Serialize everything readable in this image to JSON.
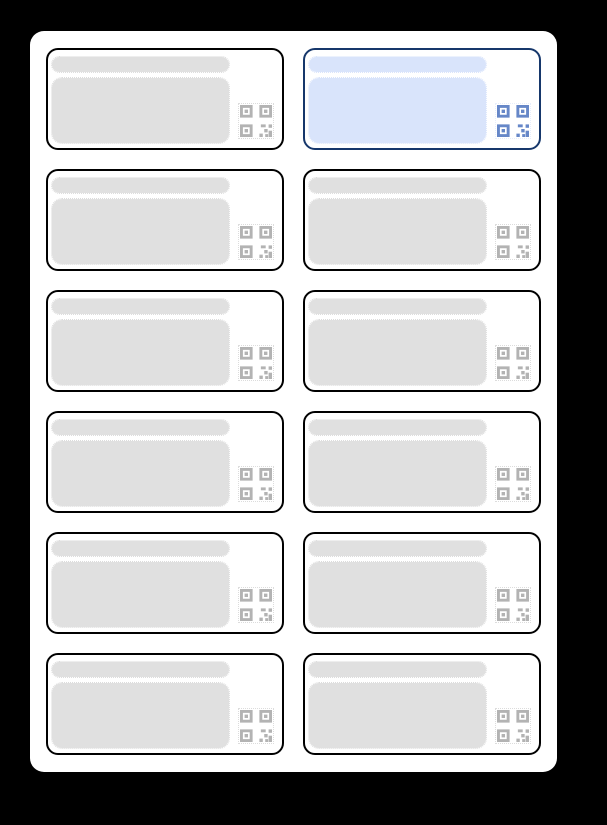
{
  "window": {
    "description": "label-sheet-preview"
  },
  "colors": {
    "page_bg": "#000000",
    "sheet_bg": "#ffffff",
    "label_border": "#000000",
    "placeholder_fill": "#e0e0e0",
    "placeholder_outline": "#dcdcdc",
    "qr_gray": "#b3b3b3",
    "selected_border": "#16376b",
    "selected_placeholder_fill": "#d9e4fb",
    "selected_qr": "#6687c8"
  },
  "sheet": {
    "rows": 6,
    "columns": 2,
    "label_count": 12,
    "selected_index": 1,
    "labels": [
      {
        "id": 1,
        "selected": false
      },
      {
        "id": 2,
        "selected": true
      },
      {
        "id": 3,
        "selected": false
      },
      {
        "id": 4,
        "selected": false
      },
      {
        "id": 5,
        "selected": false
      },
      {
        "id": 6,
        "selected": false
      },
      {
        "id": 7,
        "selected": false
      },
      {
        "id": 8,
        "selected": false
      },
      {
        "id": 9,
        "selected": false
      },
      {
        "id": 10,
        "selected": false
      },
      {
        "id": 11,
        "selected": false
      },
      {
        "id": 12,
        "selected": false
      }
    ]
  },
  "label_template": {
    "elements": [
      "title-placeholder",
      "body-placeholder",
      "qr-code-icon"
    ]
  }
}
